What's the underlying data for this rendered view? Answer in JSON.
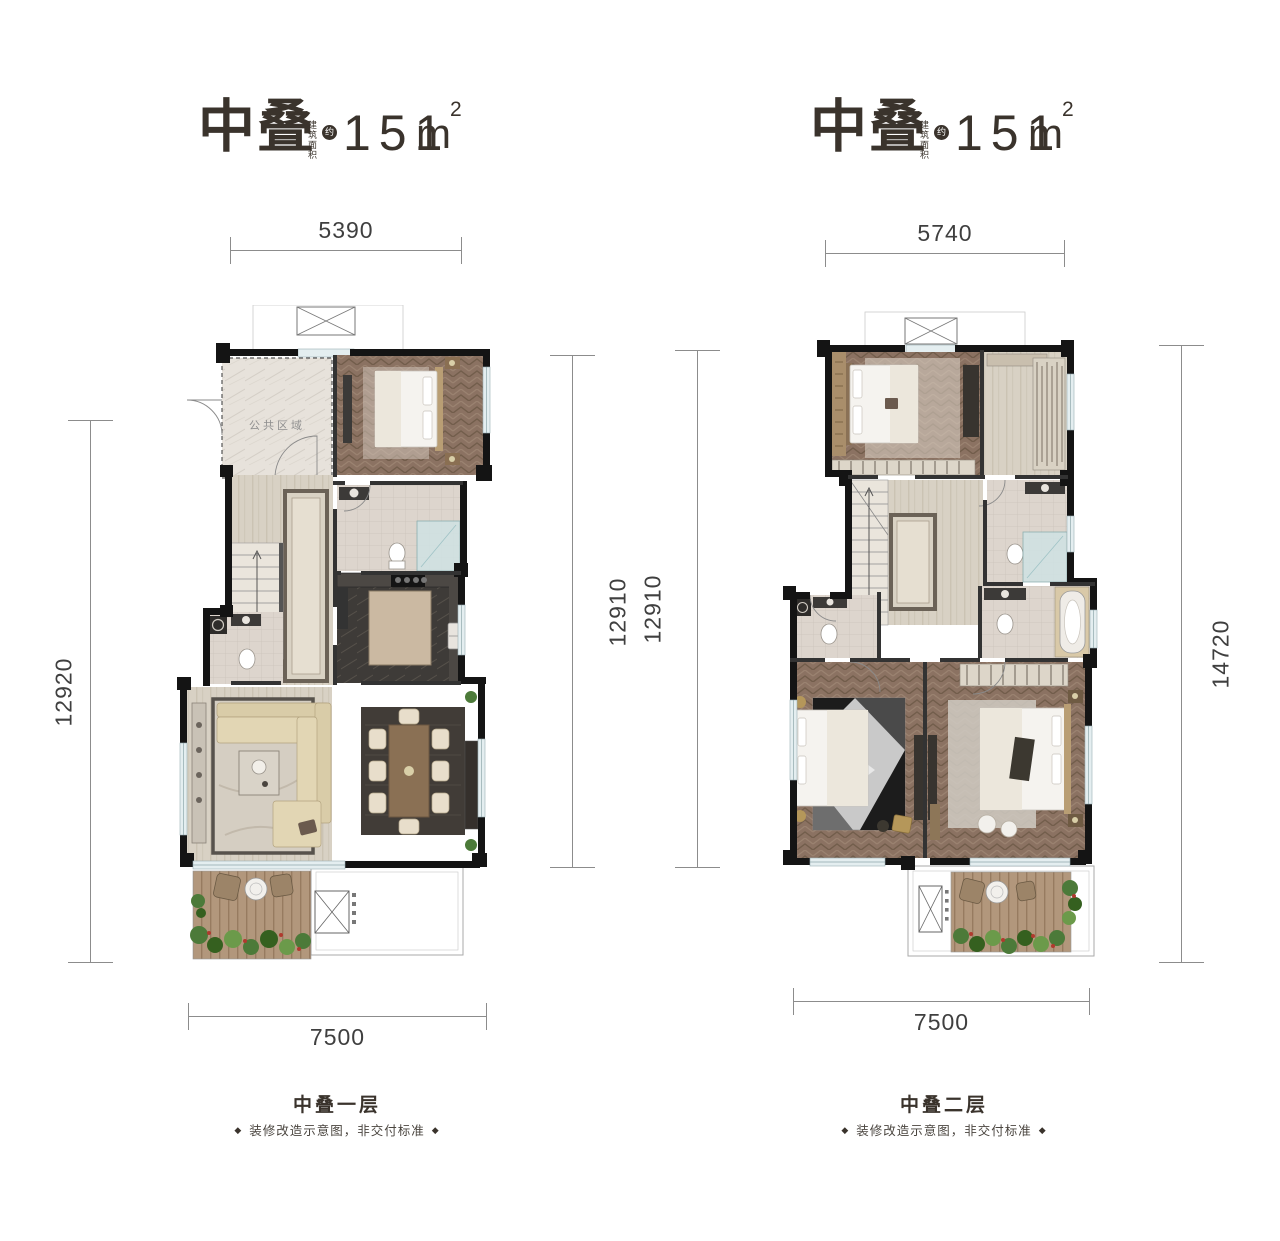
{
  "sheet": {
    "background": "#ffffff"
  },
  "plans": [
    {
      "title": "中叠",
      "area_label_vertical": "建筑面积",
      "approx_badge": "约",
      "area_value": "151",
      "area_unit_base": "m",
      "area_unit_sup": "2",
      "dims": {
        "top": "5390",
        "left": "12920",
        "right": "12910",
        "bottom": "7500"
      },
      "floor_label": "中叠一层",
      "disclaimer": "装修改造示意图，非交付标准",
      "ornament": "◆",
      "rooms": {
        "public_area": "公共区域"
      }
    },
    {
      "title": "中叠",
      "area_label_vertical": "建筑面积",
      "approx_badge": "约",
      "area_value": "151",
      "area_unit_base": "m",
      "area_unit_sup": "2",
      "dims": {
        "top": "5740",
        "left": "12910",
        "right": "14720",
        "bottom": "7500"
      },
      "floor_label": "中叠二层",
      "disclaimer": "装修改造示意图，非交付标准",
      "ornament": "◆"
    }
  ],
  "colors": {
    "title_text": "#3a332c",
    "dimension_text": "#3f3f3f",
    "dimension_line": "#8c8c8c",
    "wall": "#141414",
    "herringbone_wood": "#8b7262",
    "light_wood": "#d8d1c4",
    "balcony_deck": "#b2977c",
    "marble": "#e7e2db",
    "dark_stone": "#3e3b38",
    "window_sill": "#e4eef0",
    "plant_green": "#4c7a39",
    "flower_red": "#b03a2e"
  }
}
